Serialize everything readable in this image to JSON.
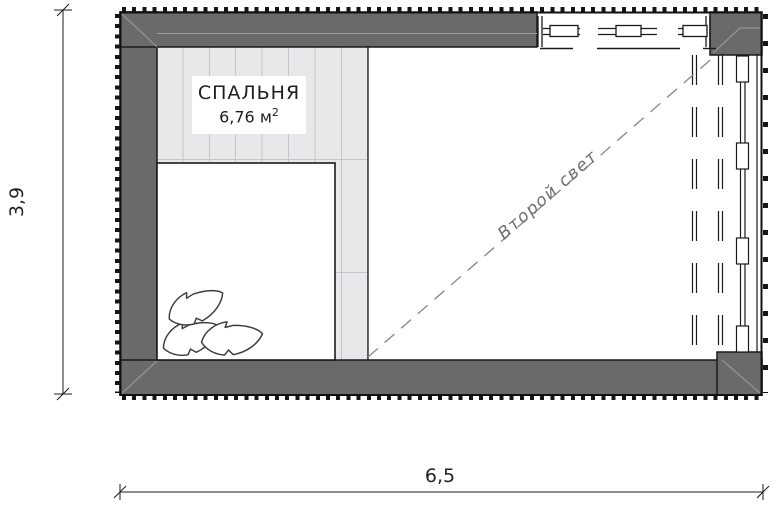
{
  "plan": {
    "room": {
      "name": "СПАЛЬНЯ",
      "area_main": "6,76 м",
      "area_sup": "2"
    },
    "annotation": {
      "second_light": "Второй свет"
    },
    "dimensions": {
      "horizontal": "6,5",
      "vertical": "3,9"
    },
    "colors": {
      "wall_fill": "#6a6a6a",
      "line": "#1a1a1a",
      "floor": "#e8e8ea",
      "floor_joint": "#c6c6ca",
      "void_dash": "#8c8c8c",
      "annotation_text": "#6f6f6f"
    }
  }
}
